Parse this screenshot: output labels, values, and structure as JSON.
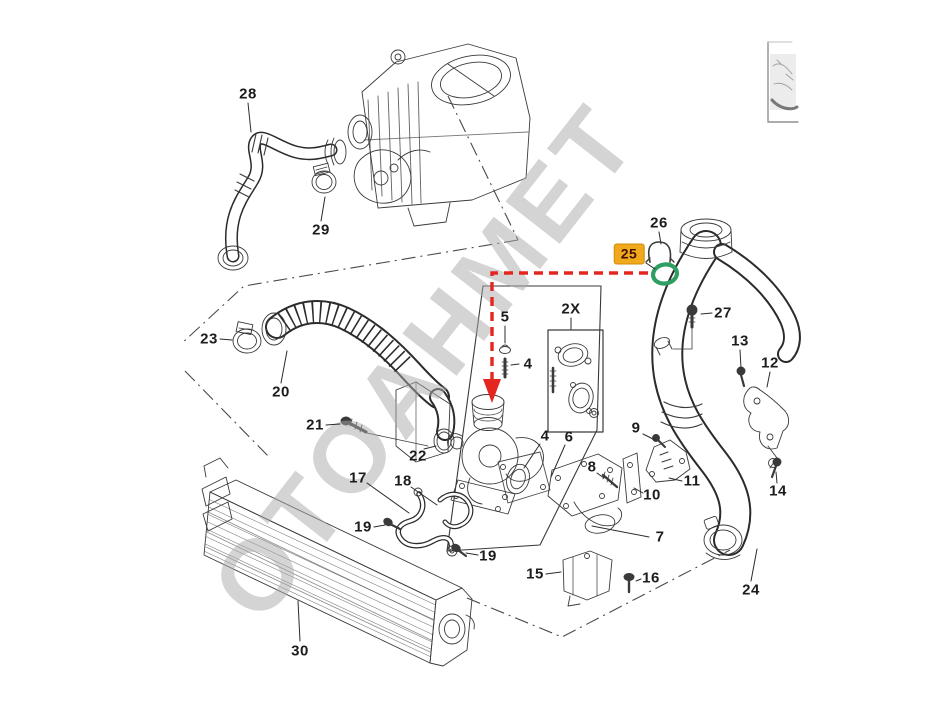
{
  "watermark": {
    "text": "OTOAHMET"
  },
  "colors": {
    "highlightBg": "#F0A91C",
    "highlightText": "#401000",
    "highlightBorder": "#D18C0A",
    "oringGreen": "#2E9E62",
    "arrowRed": "#E52520",
    "watermarkGray": "#ABABAB",
    "ink": "#3A3A3A"
  },
  "labels": [
    {
      "text": "28",
      "x": 248,
      "y": 94,
      "leader": [
        248,
        103,
        251,
        132
      ]
    },
    {
      "text": "29",
      "x": 321,
      "y": 230,
      "leader": [
        321,
        221,
        325,
        197
      ]
    },
    {
      "text": "23",
      "x": 209,
      "y": 339,
      "leader": [
        220,
        339,
        232,
        340
      ]
    },
    {
      "text": "20",
      "x": 281,
      "y": 392,
      "leader": [
        281,
        383,
        287,
        351
      ]
    },
    {
      "text": "21",
      "x": 315,
      "y": 425,
      "leader": [
        326,
        425,
        340,
        424
      ]
    },
    {
      "text": "22",
      "x": 418,
      "y": 456,
      "leader": [
        424,
        449,
        436,
        446
      ]
    },
    {
      "text": "17",
      "x": 358,
      "y": 478,
      "leader": [
        367,
        483,
        409,
        513
      ]
    },
    {
      "text": "18",
      "x": 403,
      "y": 481,
      "leader": [
        411,
        487,
        437,
        505
      ]
    },
    {
      "text": "19",
      "x": 363,
      "y": 527,
      "leader": [
        374,
        527,
        385,
        525
      ]
    },
    {
      "text": "19",
      "x": 488,
      "y": 556,
      "leader": [
        478,
        555,
        466,
        553
      ]
    },
    {
      "text": "30",
      "x": 300,
      "y": 651,
      "leader": [
        300,
        641,
        298,
        601
      ]
    },
    {
      "text": "15",
      "x": 535,
      "y": 574,
      "leader": [
        546,
        574,
        561,
        572
      ]
    },
    {
      "text": "16",
      "x": 651,
      "y": 578,
      "leader": [
        641,
        579,
        636,
        581
      ]
    },
    {
      "text": "5",
      "x": 505,
      "y": 317,
      "leader": [
        505,
        326,
        505,
        343
      ]
    },
    {
      "text": "2X",
      "x": 571,
      "y": 309,
      "leader": [
        571,
        318,
        571,
        329
      ]
    },
    {
      "text": "4",
      "x": 528,
      "y": 364,
      "leader": [
        519,
        364,
        511,
        365
      ]
    },
    {
      "text": "4",
      "x": 545,
      "y": 436,
      "leader": [
        540,
        444,
        524,
        468
      ]
    },
    {
      "text": "6",
      "x": 569,
      "y": 437,
      "leader": [
        565,
        445,
        551,
        477
      ]
    },
    {
      "text": "8",
      "x": 592,
      "y": 467,
      "leader": [
        597,
        473,
        604,
        478
      ]
    },
    {
      "text": "9",
      "x": 636,
      "y": 428,
      "leader": [
        643,
        434,
        655,
        440
      ]
    },
    {
      "text": "10",
      "x": 652,
      "y": 495,
      "leader": [
        643,
        493,
        634,
        488
      ]
    },
    {
      "text": "11",
      "x": 692,
      "y": 481,
      "leader": [
        682,
        481,
        669,
        478
      ]
    },
    {
      "text": "7",
      "x": 660,
      "y": 537,
      "leader": [
        649,
        537,
        592,
        526
      ]
    },
    {
      "text": "26",
      "x": 659,
      "y": 223,
      "leader": [
        659,
        232,
        661,
        244
      ]
    },
    {
      "text": "25",
      "x": 629,
      "y": 254,
      "leader": [
        646,
        263,
        655,
        269
      ],
      "highlight": true
    },
    {
      "text": "27",
      "x": 723,
      "y": 313,
      "leader": [
        712,
        313,
        701,
        314
      ]
    },
    {
      "text": "13",
      "x": 740,
      "y": 341,
      "leader": [
        740,
        350,
        741,
        368
      ]
    },
    {
      "text": "12",
      "x": 770,
      "y": 363,
      "leader": [
        770,
        372,
        767,
        387
      ]
    },
    {
      "text": "14",
      "x": 778,
      "y": 491,
      "leader": [
        777,
        483,
        776,
        472
      ]
    },
    {
      "text": "24",
      "x": 751,
      "y": 590,
      "leader": [
        751,
        581,
        757,
        549
      ]
    }
  ]
}
